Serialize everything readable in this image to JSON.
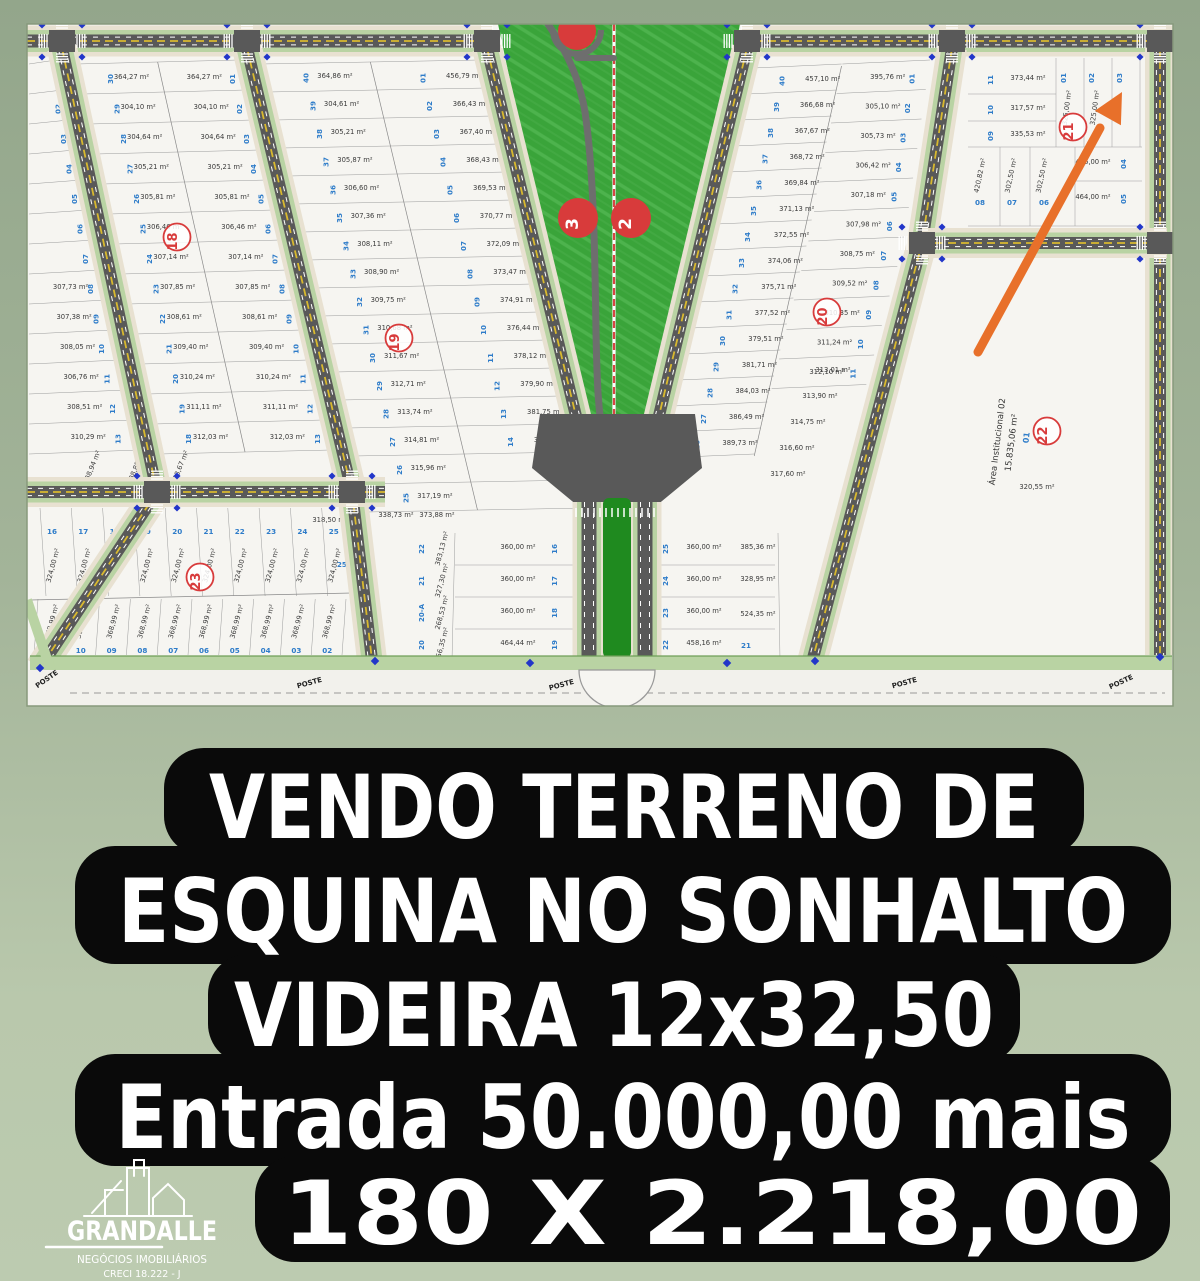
{
  "colors": {
    "background_top": "#93a68b",
    "background_bottom": "#bccbb0",
    "ad_panel": "#0a0a0a",
    "ad_text": "#ffffff",
    "lot_number_blue": "#2e7cc9",
    "marker_red": "#d83b3b",
    "arrow_orange": "#e8702a",
    "park_green": "#3aa43a",
    "road_gray": "#595959",
    "plat_white": "#f6f5f1"
  },
  "ad": {
    "lines": [
      "VENDO TERRENO DE",
      "ESQUINA NO SONHALTO",
      "VIDEIRA 12x32,50",
      "Entrada 50.000,00 mais",
      "180 X 2.218,00"
    ]
  },
  "logo": {
    "name": "GRANDALLE",
    "subtitle": "NEGÓCIOS IMOBILIÁRIOS",
    "creci": "CRECI 18.222 - J"
  },
  "map": {
    "area_unit": "m²",
    "quadra_markers": [
      "18",
      "19",
      "20",
      "21",
      "22",
      "23"
    ],
    "park_markers": [
      "3",
      "2"
    ],
    "institutional": {
      "title": "Área Institucional 02",
      "area": "15.835,06 m²",
      "lot": "01"
    },
    "boundary_label": "POSTE",
    "strips": {
      "left_edge": {
        "nums": [
          "02",
          "03",
          "04",
          "05",
          "06",
          "07",
          "08",
          "09",
          "10",
          "11",
          "12",
          "13"
        ],
        "areas": [
          "307,73",
          "307,38",
          "308,05",
          "306,76",
          "308,51",
          "310,29"
        ]
      },
      "b18": {
        "areas": [
          "364,27",
          "304,10",
          "304,64",
          "305,21",
          "305,81",
          "306,46",
          "307,14",
          "307,85",
          "308,61",
          "309,40",
          "310,24",
          "311,11",
          "312,03"
        ],
        "left_nums": [
          "30",
          "29",
          "28",
          "27",
          "26",
          "25",
          "24",
          "23",
          "22",
          "21",
          "20",
          "19",
          "18"
        ],
        "right_nums": [
          "01",
          "02",
          "03",
          "04",
          "05",
          "06",
          "07",
          "08",
          "09",
          "10",
          "11",
          "12",
          "13"
        ]
      },
      "b18_tall": {
        "areas": [
          "438,94",
          "438,88",
          "438,67"
        ],
        "left_nums": [
          "15",
          "14"
        ],
        "right_nums": [
          "17",
          "16",
          "15",
          "14"
        ]
      },
      "b19": {
        "areas": [
          "364,86",
          "304,61",
          "305,21",
          "305,87",
          "306,60",
          "307,36",
          "308,11",
          "308,90",
          "309,75",
          "310,68",
          "311,67",
          "312,71",
          "313,74",
          "314,81",
          "315,96",
          "317,19"
        ],
        "left_nums": [
          "40",
          "39",
          "38",
          "37",
          "36",
          "35",
          "34",
          "33",
          "32",
          "31",
          "30",
          "29",
          "28",
          "27",
          "26",
          "25"
        ],
        "extra_area": "318,50"
      },
      "park_left": {
        "nums": [
          "01",
          "02",
          "03",
          "04",
          "05",
          "06",
          "07",
          "08",
          "09",
          "10",
          "11",
          "12",
          "13",
          "14"
        ],
        "areas": [
          "456,79",
          "366,43",
          "367,40",
          "368,43",
          "369,53",
          "370,77",
          "372,09",
          "373,47",
          "374,91",
          "376,44",
          "378,12",
          "379,90",
          "381,75",
          "383,67"
        ]
      },
      "park_right": {
        "nums": [
          "40",
          "39",
          "38",
          "37",
          "36",
          "35",
          "34",
          "33",
          "32",
          "31",
          "30",
          "29",
          "28",
          "27",
          "26"
        ],
        "areas": [
          "457,10",
          "366,68",
          "367,67",
          "368,72",
          "369,84",
          "371,13",
          "372,55",
          "374,06",
          "375,71",
          "377,52",
          "379,51",
          "381,71",
          "384,03",
          "386,49",
          "389,73"
        ]
      },
      "b20": {
        "nums": [
          "01",
          "02",
          "03",
          "04",
          "05",
          "06",
          "07",
          "08",
          "09",
          "10",
          "11"
        ],
        "areas": [
          "395,76",
          "305,10",
          "305,73",
          "306,42",
          "307,18",
          "307,98",
          "308,75",
          "309,52",
          "310,35",
          "311,24",
          "312,10"
        ],
        "lower_areas": [
          "313,01",
          "313,90",
          "314,75",
          "316,60",
          "317,60"
        ]
      }
    },
    "b21": {
      "left_rows": [
        {
          "num": "11",
          "area": "373,44"
        },
        {
          "num": "10",
          "area": "317,57"
        },
        {
          "num": "09",
          "area": "335,53"
        }
      ],
      "top_vertical": {
        "nums": [
          "01",
          "02",
          "03"
        ],
        "area": "325,00"
      },
      "right_rows": [
        {
          "num": "04",
          "area": "416,00"
        },
        {
          "num": "05",
          "area": "464,00"
        }
      ],
      "bottom_vertical": {
        "nums": [
          "08",
          "07",
          "06"
        ],
        "areas": [
          "420,82",
          "302,50",
          "302,50"
        ]
      }
    },
    "b23": {
      "top_nums": [
        "16",
        "17",
        "18",
        "19",
        "20",
        "21",
        "22",
        "23",
        "24",
        "25"
      ],
      "top_corner": "25-A",
      "top_area": "324,00",
      "bottom_nums": [
        "11",
        "10",
        "09",
        "08",
        "07",
        "06",
        "05",
        "04",
        "03",
        "02"
      ],
      "bottom_area": "368,99"
    },
    "center_bottom": {
      "left_outer": {
        "nums": [
          "22",
          "21",
          "20-A",
          "20"
        ],
        "areas": [
          "383,13",
          "327,30",
          "268,53",
          "256,35"
        ]
      },
      "left_inner": {
        "nums": [
          "16",
          "17",
          "18",
          "19"
        ],
        "areas": [
          "360,00",
          "360,00",
          "360,00",
          "464,44"
        ]
      },
      "right_inner": {
        "nums": [
          "25",
          "24",
          "23",
          "22"
        ],
        "areas": [
          "360,00",
          "360,00",
          "360,00",
          "458,16"
        ]
      },
      "right_outer": {
        "num": "21",
        "areas": [
          "385,36",
          "328,95",
          "524,35"
        ]
      },
      "singles": [
        "338,73",
        "373,88",
        "320,55",
        "318,50"
      ]
    }
  }
}
